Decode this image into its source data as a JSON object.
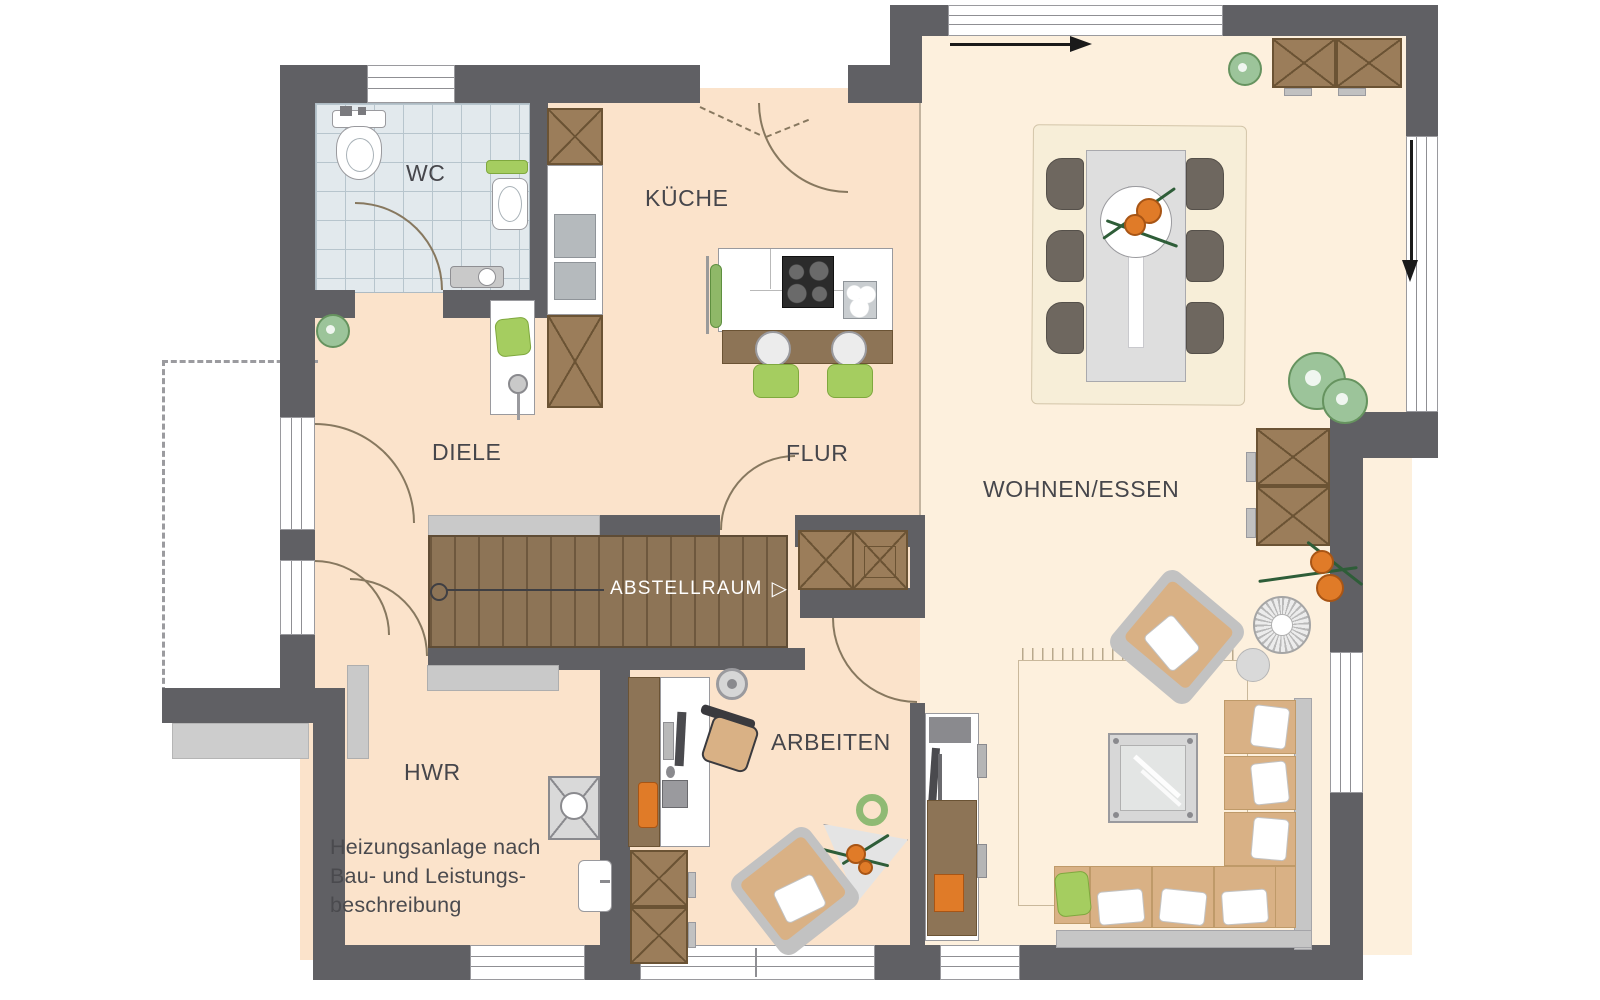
{
  "plan": {
    "rooms": {
      "wc": "WC",
      "kueche": "KÜCHE",
      "diele": "DIELE",
      "flur": "FLUR",
      "wohnen_essen": "WOHNEN/ESSEN",
      "arbeiten": "ARBEITEN",
      "hwr": "HWR"
    },
    "stair": {
      "label": "ABSTELLRAUM",
      "arrow": "▷"
    },
    "annotation": {
      "line1": "Heizungsanlage nach",
      "line2": "Bau- und Leistungs-",
      "line3": "beschreibung"
    },
    "colors": {
      "wall": "#606064",
      "floor": "#fbe3cb",
      "floor_living": "#fdf0dd",
      "wood": "#8d7456",
      "wood2": "#9b7d5a",
      "accent_green": "#a5cd60",
      "accent_orange": "#e07b28"
    }
  }
}
